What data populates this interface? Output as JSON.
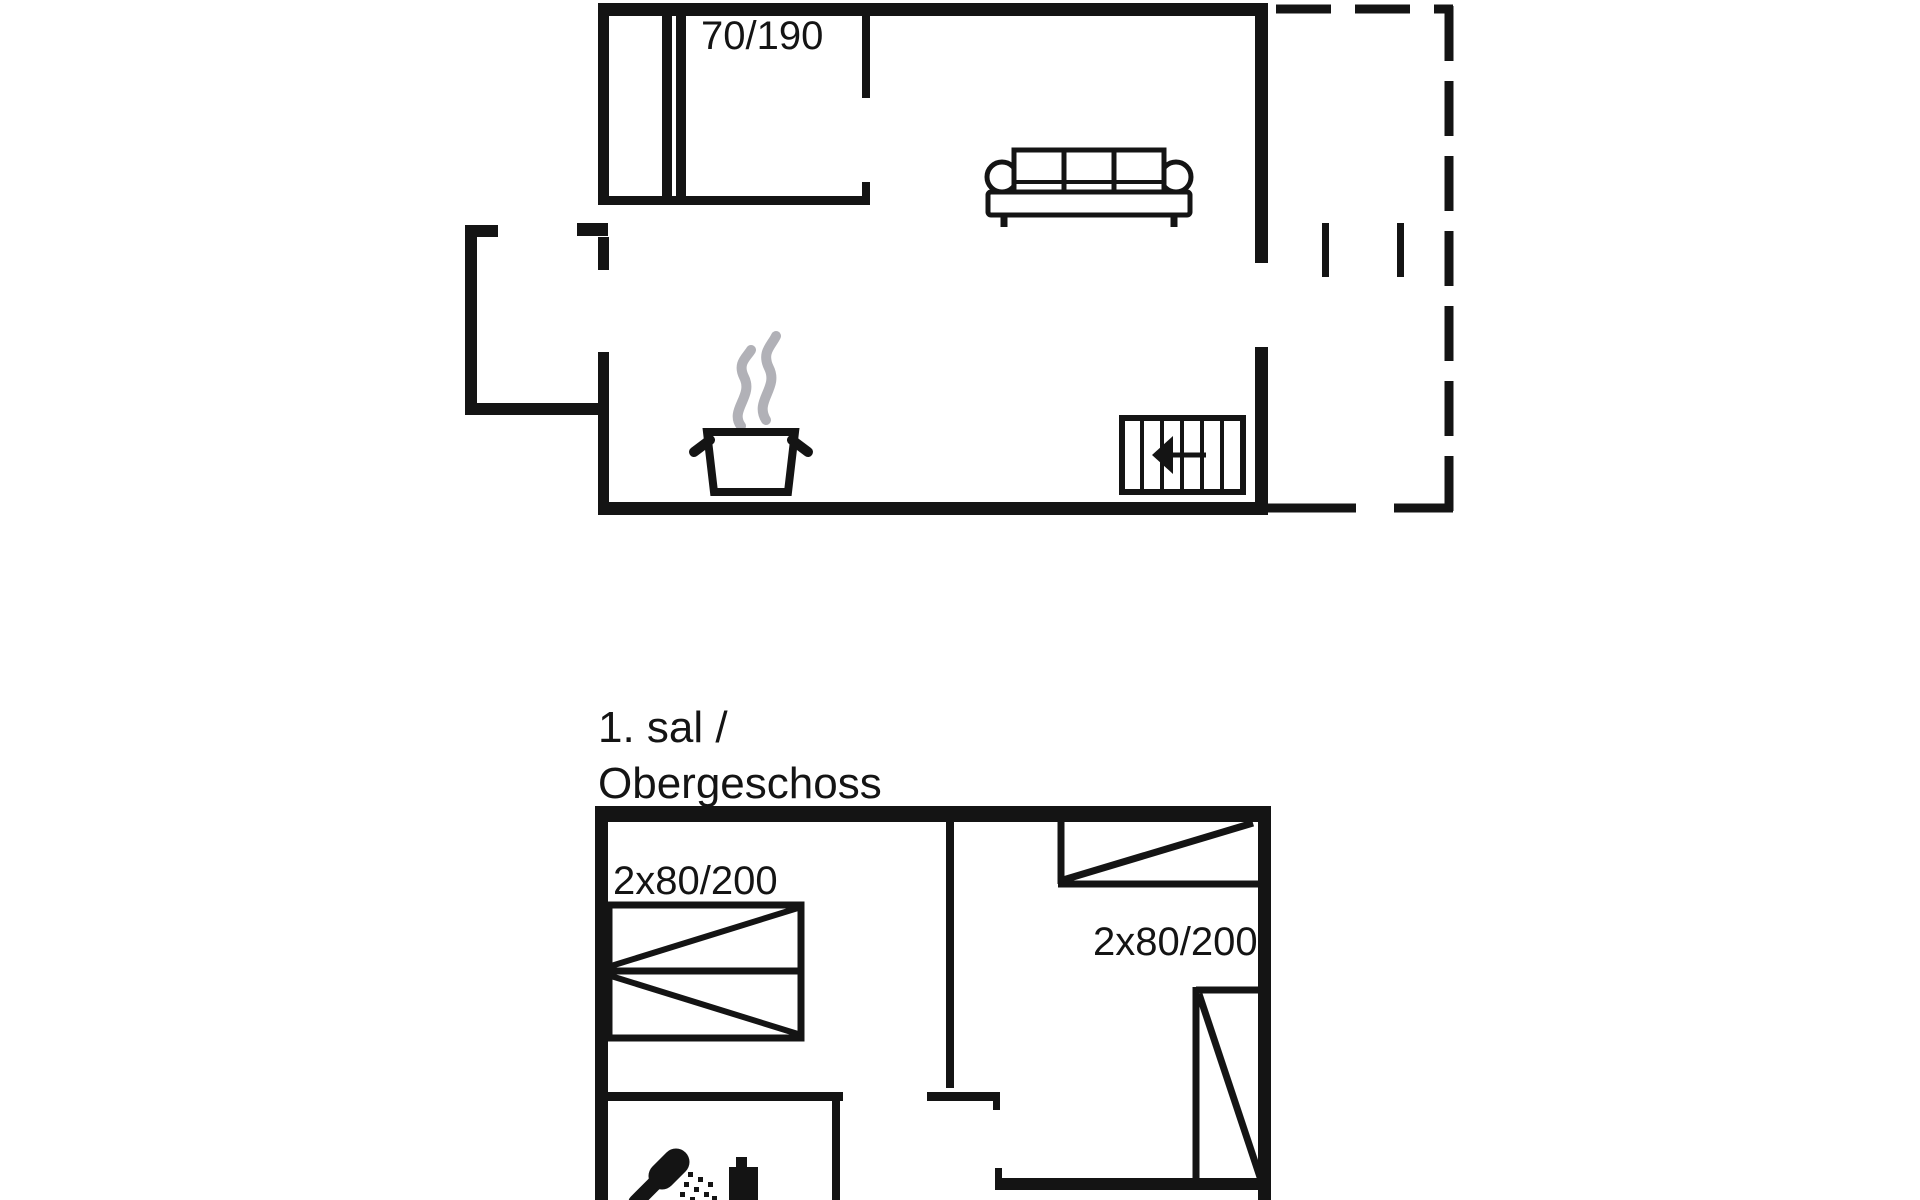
{
  "floorplan": {
    "colors": {
      "line": "#141414",
      "steam": "#b1b1b7",
      "background": "#ffffff"
    },
    "ground_floor": {
      "bed_size_label": "70/190",
      "symbols": [
        "sofa-icon",
        "cooking-pot-icon",
        "steam-icon",
        "stairs-icon",
        "stairs-direction-arrow",
        "terrace-dashed-outline"
      ]
    },
    "upper_floor": {
      "title_line1": "1. sal /",
      "title_line2": "Obergeschoss",
      "bed_size_label_left": "2x80/200",
      "bed_size_label_right": "2x80/200",
      "symbols": [
        "double-bed-icon",
        "single-bed-icon",
        "shower-icon",
        "water-heater-icon"
      ]
    }
  }
}
